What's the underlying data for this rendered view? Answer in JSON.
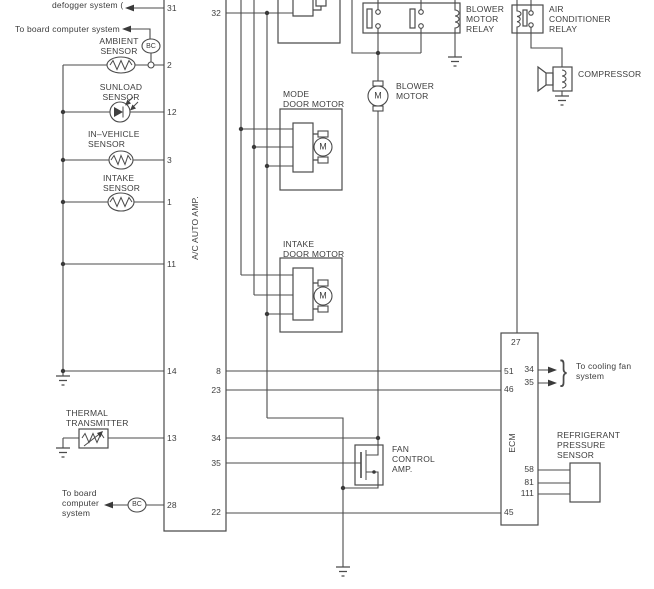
{
  "colors": {
    "background": "#ffffff",
    "line": "#4b4b4b",
    "text": "#3d3d3d"
  },
  "diagram": {
    "labels": [
      {
        "name": "label-defogger-system",
        "text": "defogger system (",
        "x": 52,
        "y": 0
      },
      {
        "name": "label-to-board-computer-top",
        "text": "To board computer system",
        "x": 15,
        "y": 24
      },
      {
        "name": "label-ambient-sensor",
        "text": "AMBIENT\nSENSOR",
        "x": 119,
        "y": 36,
        "align": "center"
      },
      {
        "name": "label-bc-badge-top",
        "text": "BC",
        "x": 151,
        "y": 43,
        "align": "center",
        "cls": "badge"
      },
      {
        "name": "label-sunload-sensor",
        "text": "SUNLOAD\nSENSOR",
        "x": 121,
        "y": 82,
        "align": "center"
      },
      {
        "name": "label-in-vehicle-sensor",
        "text": "IN–VEHICLE\nSENSOR",
        "x": 88,
        "y": 129
      },
      {
        "name": "label-intake-sensor",
        "text": "INTAKE\nSENSOR",
        "x": 103,
        "y": 173
      },
      {
        "name": "label-ac-auto-amp",
        "text": "A/C AUTO AMP.",
        "x": 195,
        "y": 228,
        "rot": true
      },
      {
        "name": "label-thermal-transmitter",
        "text": "THERMAL\nTRANSMITTER",
        "x": 66,
        "y": 408
      },
      {
        "name": "label-to-board-computer-bottom",
        "text": "To board\ncomputer\nsystem",
        "x": 62,
        "y": 488
      },
      {
        "name": "label-bc-badge-bottom",
        "text": "BC",
        "x": 137,
        "y": 501,
        "align": "center",
        "cls": "badge"
      },
      {
        "name": "label-mode-door-motor",
        "text": "MODE\nDOOR MOTOR",
        "x": 283,
        "y": 89
      },
      {
        "name": "label-intake-door-motor",
        "text": "INTAKE\nDOOR MOTOR",
        "x": 283,
        "y": 239
      },
      {
        "name": "label-blower-motor",
        "text": "BLOWER\nMOTOR",
        "x": 396,
        "y": 81
      },
      {
        "name": "label-blower-motor-relay",
        "text": "BLOWER\nMOTOR\nRELAY",
        "x": 466,
        "y": 4
      },
      {
        "name": "label-air-conditioner-relay",
        "text": "AIR\nCONDITIONER\nRELAY",
        "x": 549,
        "y": 4
      },
      {
        "name": "label-compressor",
        "text": "COMPRESSOR",
        "x": 578,
        "y": 69
      },
      {
        "name": "label-fan-control-amp",
        "text": "FAN\nCONTROL\nAMP.",
        "x": 392,
        "y": 444
      },
      {
        "name": "label-ecm",
        "text": "ECM",
        "x": 512,
        "y": 443,
        "rot": true
      },
      {
        "name": "label-to-cooling-fan-system",
        "text": "To cooling fan\nsystem",
        "x": 576,
        "y": 361
      },
      {
        "name": "label-refrigerant-pressure-sensor",
        "text": "REFRIGERANT\nPRESSURE\nSENSOR",
        "x": 557,
        "y": 430
      },
      {
        "name": "label-cooling-fan-brace",
        "text": "}",
        "x": 560,
        "y": 357,
        "cls": "brace"
      },
      {
        "name": "label-mode-motor-m",
        "text": "M",
        "x": 323,
        "y": 147,
        "cls": "m"
      },
      {
        "name": "label-intake-motor-m",
        "text": "M",
        "x": 323,
        "y": 296,
        "cls": "m"
      },
      {
        "name": "label-blower-motor-m",
        "text": "M",
        "x": 378,
        "y": 96,
        "cls": "m"
      }
    ],
    "pins": [
      {
        "name": "pin-amp-31",
        "text": "31",
        "x": 167,
        "y": 3
      },
      {
        "name": "pin-amp-2",
        "text": "2",
        "x": 167,
        "y": 60
      },
      {
        "name": "pin-amp-12",
        "text": "12",
        "x": 167,
        "y": 107
      },
      {
        "name": "pin-amp-3",
        "text": "3",
        "x": 167,
        "y": 155
      },
      {
        "name": "pin-amp-1",
        "text": "1",
        "x": 167,
        "y": 197
      },
      {
        "name": "pin-amp-11",
        "text": "11",
        "x": 167,
        "y": 259
      },
      {
        "name": "pin-amp-14",
        "text": "14",
        "x": 167,
        "y": 366
      },
      {
        "name": "pin-amp-13",
        "text": "13",
        "x": 167,
        "y": 433
      },
      {
        "name": "pin-amp-28",
        "text": "28",
        "x": 167,
        "y": 500
      },
      {
        "name": "pin-amp-32",
        "text": "32",
        "x": 196,
        "y": 8,
        "w": 25,
        "align": "right"
      },
      {
        "name": "pin-amp-8",
        "text": "8",
        "x": 196,
        "y": 366,
        "w": 25,
        "align": "right"
      },
      {
        "name": "pin-amp-23",
        "text": "23",
        "x": 196,
        "y": 385,
        "w": 25,
        "align": "right"
      },
      {
        "name": "pin-amp-34",
        "text": "34",
        "x": 196,
        "y": 433,
        "w": 25,
        "align": "right"
      },
      {
        "name": "pin-amp-35",
        "text": "35",
        "x": 196,
        "y": 458,
        "w": 25,
        "align": "right"
      },
      {
        "name": "pin-amp-22",
        "text": "22",
        "x": 196,
        "y": 507,
        "w": 25,
        "align": "right"
      },
      {
        "name": "pin-ecm-27",
        "text": "27",
        "x": 511,
        "y": 337
      },
      {
        "name": "pin-ecm-51",
        "text": "51",
        "x": 504,
        "y": 366
      },
      {
        "name": "pin-ecm-46",
        "text": "46",
        "x": 504,
        "y": 384
      },
      {
        "name": "pin-ecm-45",
        "text": "45",
        "x": 504,
        "y": 507
      },
      {
        "name": "pin-ecm-34",
        "text": "34",
        "x": 513,
        "y": 364,
        "w": 21,
        "align": "right"
      },
      {
        "name": "pin-ecm-35",
        "text": "35",
        "x": 513,
        "y": 377,
        "w": 21,
        "align": "right"
      },
      {
        "name": "pin-ecm-58",
        "text": "58",
        "x": 513,
        "y": 464,
        "w": 21,
        "align": "right"
      },
      {
        "name": "pin-ecm-81",
        "text": "81",
        "x": 513,
        "y": 477,
        "w": 21,
        "align": "right"
      },
      {
        "name": "pin-ecm-111",
        "text": "111",
        "x": 510,
        "y": 488,
        "w": 24,
        "align": "right"
      }
    ]
  }
}
